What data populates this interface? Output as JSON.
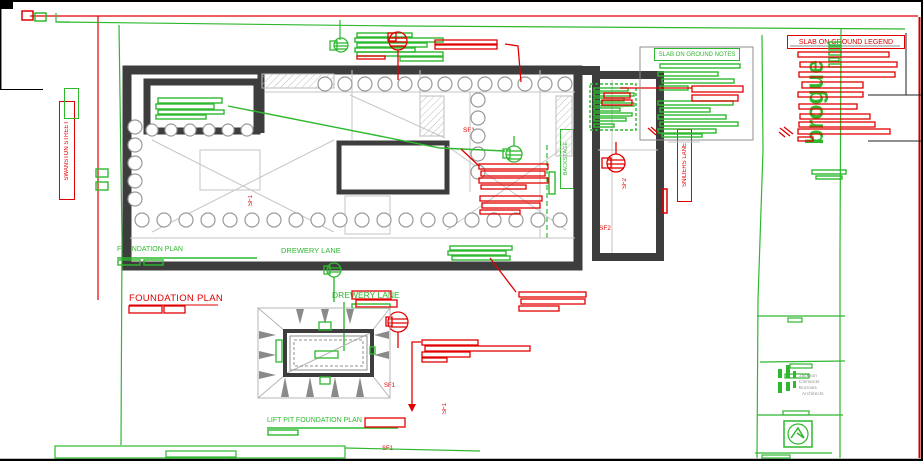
{
  "sheet": {
    "titles": {
      "main_red": "FOUNDATION PLAN",
      "main_green": "FOUNDATION PLAN",
      "lift_pit": "LIFT PIT FOUNDATION PLAN",
      "legend": "SLAB ON GROUND LEGEND",
      "notes": "SLAB ON GROUND NOTES"
    },
    "streets": {
      "top": "DREWERY LANE",
      "bottom": "DREWERY LANE",
      "right": "SNIDERS LANE",
      "left": "SWANSTON STREET"
    },
    "labels": {
      "backstage": "BACKSTAGE",
      "sf1": "SF1",
      "sf2": "SF2"
    },
    "logo_text": "brogue",
    "firm_lines": [
      "Jackson",
      "Clements",
      "Burrows",
      "Architects"
    ],
    "colors": {
      "annotation_green": "#2eb82e",
      "annotation_red": "#e10000",
      "wall_gray": "#3d3d3d",
      "sheet_border_red": "#cc0000"
    }
  }
}
